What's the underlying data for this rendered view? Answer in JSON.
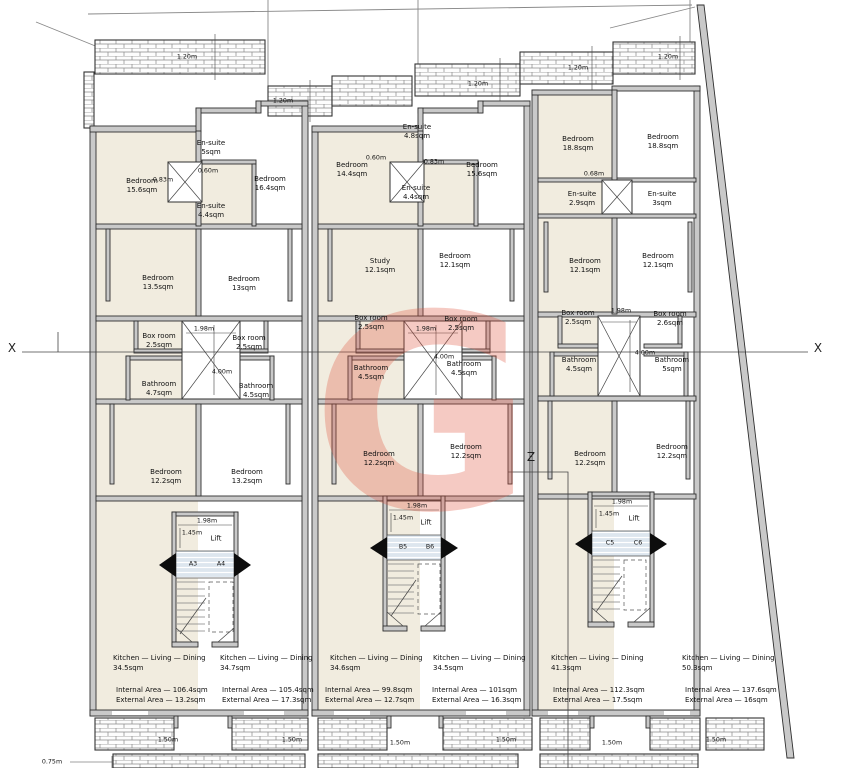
{
  "watermark": {
    "letter": "G",
    "color": "#e0523c"
  },
  "markers": {
    "x_left": "X",
    "x_right": "X",
    "z": "Z"
  },
  "top_dims": [
    "1.20m",
    "1.20m",
    "1.20m",
    "1.20m",
    "1.20m"
  ],
  "bottom_dims": [
    "1.50m",
    "1.50m",
    "1.50m",
    "1.50m",
    "1.50m",
    "1.50m"
  ],
  "offset_dim": "0.75m",
  "unit_a": {
    "bedroom_1": "Bedroom\n15.6sqm",
    "ensuite_1": "En-suite\n5sqm",
    "bedroom_2": "Bedroom\n16.4sqm",
    "ensuite_2": "En-suite\n4.4sqm",
    "dim_a": "0.83m",
    "dim_b": "0.60m",
    "bedroom_3": "Bedroom\n13.5sqm",
    "bedroom_4": "Bedroom\n13sqm",
    "box_1": "Box room\n2.5sqm",
    "box_2": "Box room\n2.5sqm",
    "shaft_w": "1.98m",
    "shaft_h": "4.00m",
    "bath_1": "Bathroom\n4.7sqm",
    "bath_2": "Bathroom\n4.5sqm",
    "bedroom_5": "Bedroom\n12.2sqm",
    "bedroom_6": "Bedroom\n13.2sqm",
    "lift_w": "1.98m",
    "lift_d": "1.45m",
    "lift": "Lift",
    "flat_l": "A3",
    "flat_r": "A4",
    "kitchen_l": "Kitchen — Living — Dining\n34.5sqm",
    "areas_l": "Internal Area — 106.4sqm\nExternal Area — 13.2sqm",
    "kitchen_r": "Kitchen — Living — Dining\n34.7sqm",
    "areas_r": "Internal Area — 105.4sqm\nExternal Area — 17.3sqm"
  },
  "unit_b": {
    "bedroom_1": "Bedroom\n14.4sqm",
    "ensuite_1": "En-suite\n4.8sqm",
    "bedroom_2": "Bedroom\n15.6sqm",
    "ensuite_2": "En-suite\n4.4sqm",
    "dim_a": "0.60m",
    "dim_b": "0.83m",
    "study": "Study\n12.1sqm",
    "bedroom_3": "Bedroom\n12.1sqm",
    "box_1": "Box room\n2.5sqm",
    "box_2": "Box room\n2.5sqm",
    "shaft_w": "1.98m",
    "shaft_h": "4.00m",
    "bath_1": "Bathroom\n4.5sqm",
    "bath_2": "Bathroom\n4.5sqm",
    "bedroom_4": "Bedroom\n12.2sqm",
    "bedroom_5": "Bedroom\n12.2sqm",
    "lift_w": "1.98m",
    "lift_d": "1.45m",
    "lift": "Lift",
    "flat_l": "B5",
    "flat_r": "B6",
    "kitchen_l": "Kitchen — Living — Dining\n34.6sqm",
    "areas_l": "Internal Area — 99.8sqm\nExternal Area — 12.7sqm",
    "kitchen_r": "Kitchen — Living — Dining\n34.5sqm",
    "areas_r": "Internal Area — 101sqm\nExternal Area — 16.3sqm"
  },
  "unit_c": {
    "bedroom_1": "Bedroom\n18.8sqm",
    "bedroom_2": "Bedroom\n18.8sqm",
    "dim_a": "0.68m",
    "ensuite_1": "En-suite\n2.9sqm",
    "ensuite_2": "En-suite\n3sqm",
    "bedroom_3": "Bedroom\n12.1sqm",
    "bedroom_4": "Bedroom\n12.1sqm",
    "box_1": "Box room\n2.5sqm",
    "box_2": "Box room\n2.6sqm",
    "shaft_w": "1.98m",
    "shaft_h": "4.00m",
    "bath_1": "Bathroom\n4.5sqm",
    "bath_2": "Bathroom\n5sqm",
    "bedroom_5": "Bedroom\n12.2sqm",
    "bedroom_6": "Bedroom\n12.2sqm",
    "lift_w": "1.98m",
    "lift_d": "1.45m",
    "lift": "Lift",
    "flat_l": "C5",
    "flat_r": "C6",
    "kitchen_l": "Kitchen — Living — Dining\n41.3sqm",
    "areas_l": "Internal Area — 112.3sqm\nExternal Area — 17.5sqm"
  },
  "unit_d": {
    "kitchen": "Kitchen — Living — Dining\n50.3sqm",
    "areas": "Internal Area — 137.6sqm\nExternal Area — 16sqm"
  }
}
